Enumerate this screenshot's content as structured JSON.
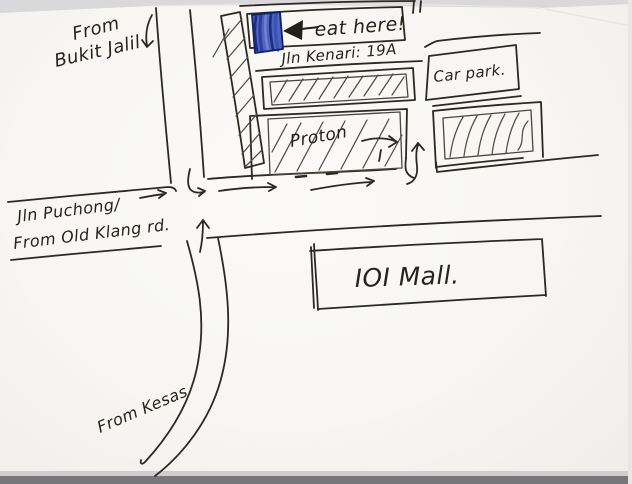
{
  "labels": {
    "from_bukit_jalil_line1": "From",
    "from_bukit_jalil_line2": "Bukit Jalil",
    "jln_puchong_line1": "Jln Puchong/",
    "jln_puchong_line2": "From Old Klang rd.",
    "from_kesas": "From Kesas",
    "eat_here": "eat here!",
    "jln_kenari": "Jln Kenari: 19A",
    "proton": "Proton",
    "car_park": "Car park.",
    "ioi_mall": "IOI Mall."
  },
  "icons": {
    "eat_here_pointer": "◀",
    "bukit_jalil_down_arrow": "↓",
    "road_right_arrow": "→",
    "intersection_hook_right_arrow": "↳",
    "kesas_up_arrow": "↑",
    "kenari_turn_up_arrow": "↑",
    "proton_right_arrow": "→"
  },
  "colors": {
    "ink": "#2c2924",
    "paper": "#f8f7f4",
    "marker_blue": "#3a53b1",
    "marker_blue_dark": "#1b2a7d",
    "scan_edge_dark": "#77767a"
  }
}
